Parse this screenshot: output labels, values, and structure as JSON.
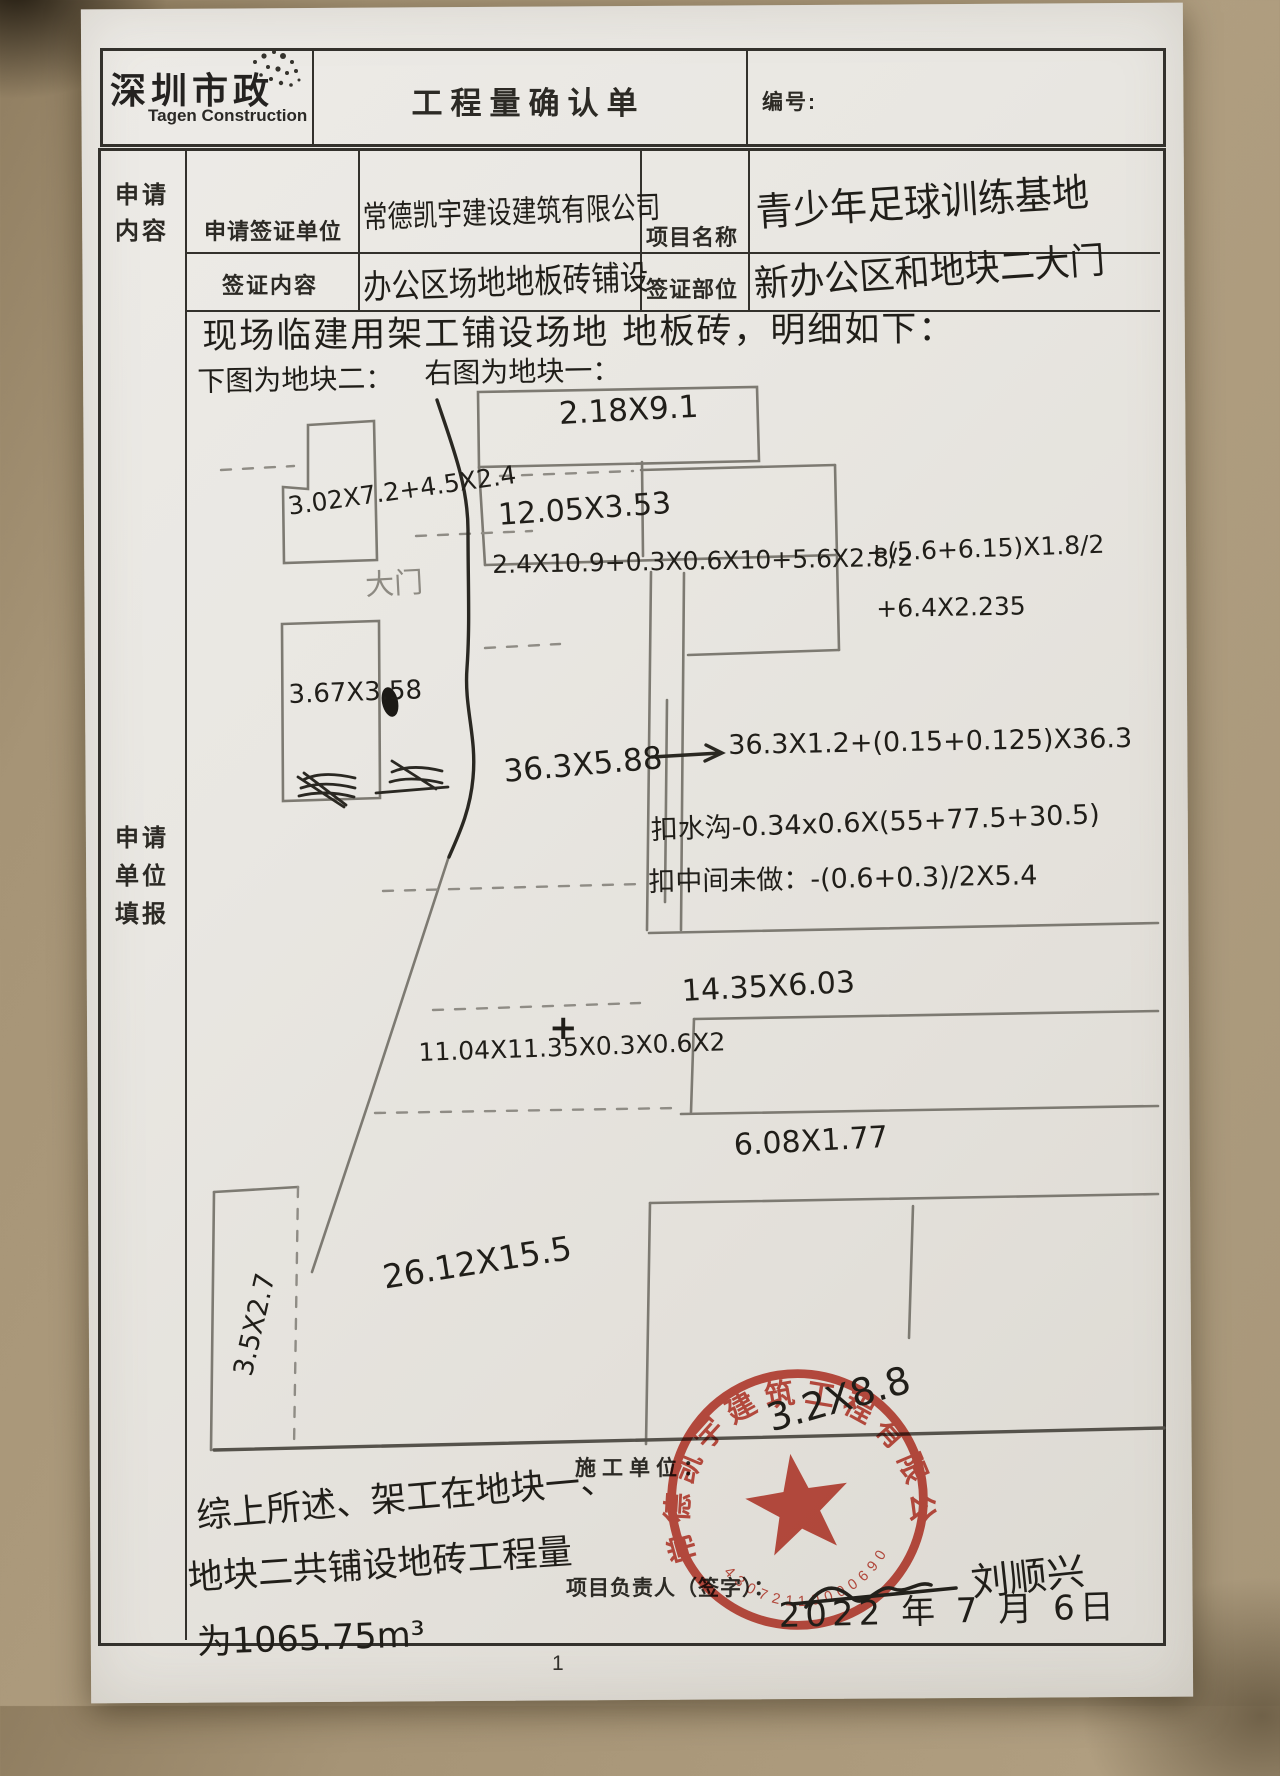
{
  "header": {
    "logo_cn": "深圳市政",
    "logo_en": "Tagen Construction",
    "title": "工程量确认单",
    "serial_label": "编号:"
  },
  "form": {
    "left_label_top": "申请内容",
    "left_label_main": "申请单位填报",
    "apply_unit_label": "申请签证单位",
    "apply_unit_value": "常德凯宇建设建筑有限公司",
    "project_name_label": "项目名称",
    "project_name_value": "青少年足球训练基地",
    "visa_content_label": "签证内容",
    "visa_content_value": "办公区场地地板砖铺设",
    "visa_location_label": "签证部位",
    "visa_location_value": "新办公区和地块二大门"
  },
  "sketch": {
    "intro": "现场临建用架工铺设场地 地板砖，明细如下：",
    "caption_left": "下图为地块二：",
    "caption_right": "右图为地块一：",
    "gate": "大门",
    "dims": {
      "block1_top": "2.18X9.1",
      "block1_second": "12.05X3.53",
      "formula1": "2.4X10.9+0.3X0.6X10+5.6X2.8/2",
      "formula1b": "+(5.6+6.15)X1.8/2",
      "formula1c": "+6.4X2.235",
      "gatehouse": "3.02X7.2+4.5X2.4",
      "room": "3.67X3.58",
      "strip": "36.3X5.88",
      "strip_formula": "36.3X1.2+(0.15+0.125)X36.3",
      "deduct_ditch": "扣水沟-0.34x0.6X(55+77.5+30.5)",
      "deduct_middle": "扣中间未做：-(0.6+0.3)/2X5.4",
      "mid_rect": "14.35X6.03",
      "mid_formula": "11.04X11.35X0.3X0.6X2",
      "mid_plus_fix": "+",
      "lower_rect": "6.08X1.77",
      "big_area": "26.12X15.5",
      "small_rect": "3.5X2.7",
      "stamp_note": "3.2X8.8"
    }
  },
  "footer": {
    "builder_label": "施工单位：",
    "manager_label": "项目负责人（签字）：",
    "manager_name": "刘顺兴",
    "summary_line1": "综上所述、架工在地块一、",
    "summary_line2": "地块二共铺设地砖工程量",
    "summary_line3": "为1065.75m³",
    "date": "2022 年 7 月 6日",
    "page_number": "1"
  },
  "stamp": {
    "company": "常德凯宇建筑工程有限公司",
    "number": "43072110000690",
    "color": "#c23a2c"
  }
}
